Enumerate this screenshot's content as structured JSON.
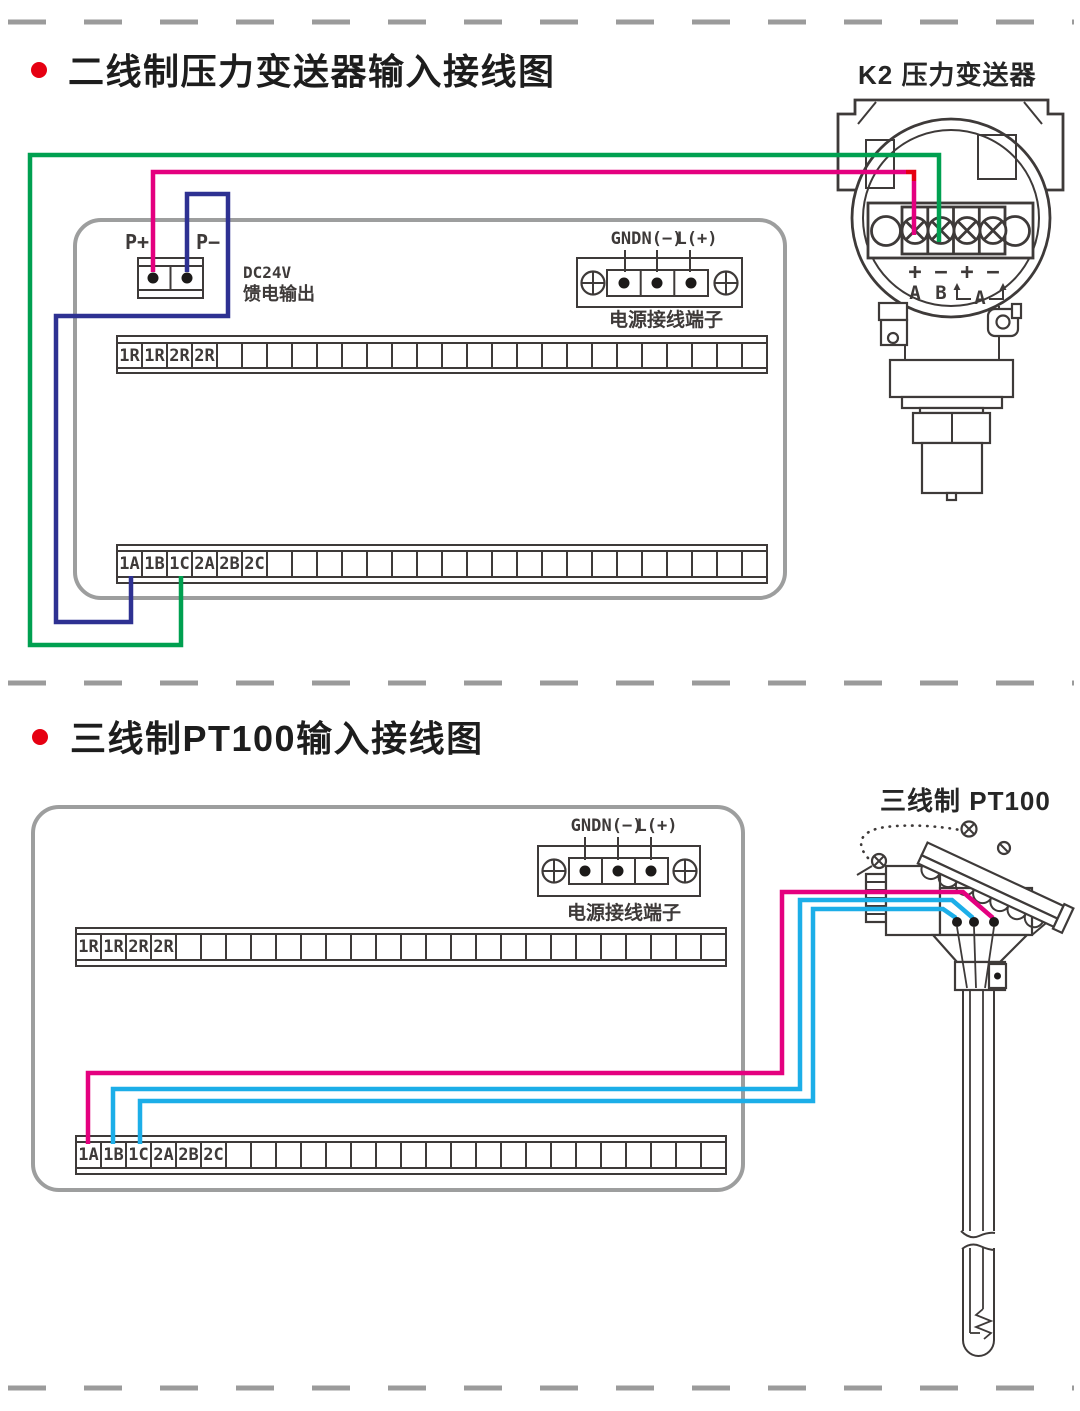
{
  "colors": {
    "wire_green": "#00a050",
    "wire_pink": "#e4007f",
    "wire_blue": "#2e3192",
    "wire_cyan": "#1caee8",
    "wire_red_joint": "#e60012",
    "bullet_red": "#e60012"
  },
  "section1": {
    "title": "二线制压力变送器输入接线图",
    "transmitter_label": "K2 压力变送器",
    "feed_terminal": {
      "p_plus": "P+",
      "p_minus": "P−",
      "note_line1": "DC24V",
      "note_line2": "馈电输出"
    },
    "power_terminal": {
      "labels": [
        "GND",
        "N(−)",
        "L(+)"
      ],
      "caption": "电源接线端子"
    },
    "terminal_row_top": [
      "1R",
      "1R",
      "2R",
      "2R"
    ],
    "terminal_row_bottom": [
      "1A",
      "1B",
      "1C",
      "2A",
      "2B",
      "2C"
    ],
    "transmitter_terminals": {
      "signs": [
        "+",
        "−",
        "+",
        "−"
      ],
      "letters": [
        "A",
        "B"
      ],
      "bracket_label": "A"
    }
  },
  "section2": {
    "title": "三线制PT100输入接线图",
    "sensor_label": "三线制 PT100",
    "power_terminal": {
      "labels": [
        "GND",
        "N(−)",
        "L(+)"
      ],
      "caption": "电源接线端子"
    },
    "terminal_row_top": [
      "1R",
      "1R",
      "2R",
      "2R"
    ],
    "terminal_row_bottom": [
      "1A",
      "1B",
      "1C",
      "2A",
      "2B",
      "2C"
    ]
  }
}
